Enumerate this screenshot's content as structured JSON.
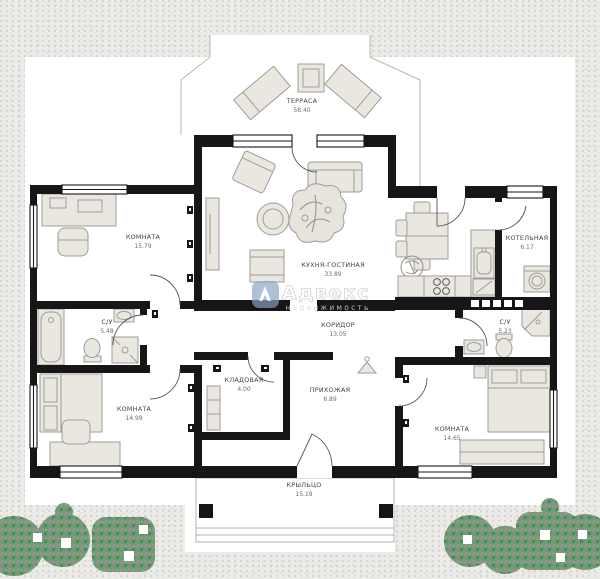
{
  "watermark": {
    "brand": "Адвекс",
    "tagline": "недвижимость"
  },
  "rooms": [
    {
      "id": "terrace",
      "name": "ТЕРРАСА",
      "area": "58.40"
    },
    {
      "id": "room-nw",
      "name": "КОМНАТА",
      "area": "15.79"
    },
    {
      "id": "kitchen-living",
      "name": "КУХНЯ-ГОСТИНАЯ",
      "area": "33.89"
    },
    {
      "id": "boiler-room",
      "name": "КОТЕЛЬНАЯ",
      "area": "6.17"
    },
    {
      "id": "bath-left",
      "name": "С/У",
      "area": "5.48"
    },
    {
      "id": "corridor",
      "name": "КОРИДОР",
      "area": "13.05"
    },
    {
      "id": "bath-right",
      "name": "С/У",
      "area": "5.23"
    },
    {
      "id": "storage",
      "name": "КЛАДОВАЯ",
      "area": "4.00"
    },
    {
      "id": "entry-hall",
      "name": "ПРИХОЖАЯ",
      "area": "6.89"
    },
    {
      "id": "room-sw",
      "name": "КОМНАТА",
      "area": "14.99"
    },
    {
      "id": "room-se",
      "name": "КОМНАТА",
      "area": "14.65"
    },
    {
      "id": "porch",
      "name": "КРЫЛЬЦО",
      "area": "15.19"
    }
  ],
  "colors": {
    "wall": "#161616",
    "plot": "#ffffff",
    "background": "#ecebe8",
    "furniture_fill": "#eae7e1",
    "furniture_line": "#9d9d98",
    "bush_green": "#6d9b72",
    "bush_gray": "#8f918d",
    "logo_blue": "#89a4c4"
  }
}
